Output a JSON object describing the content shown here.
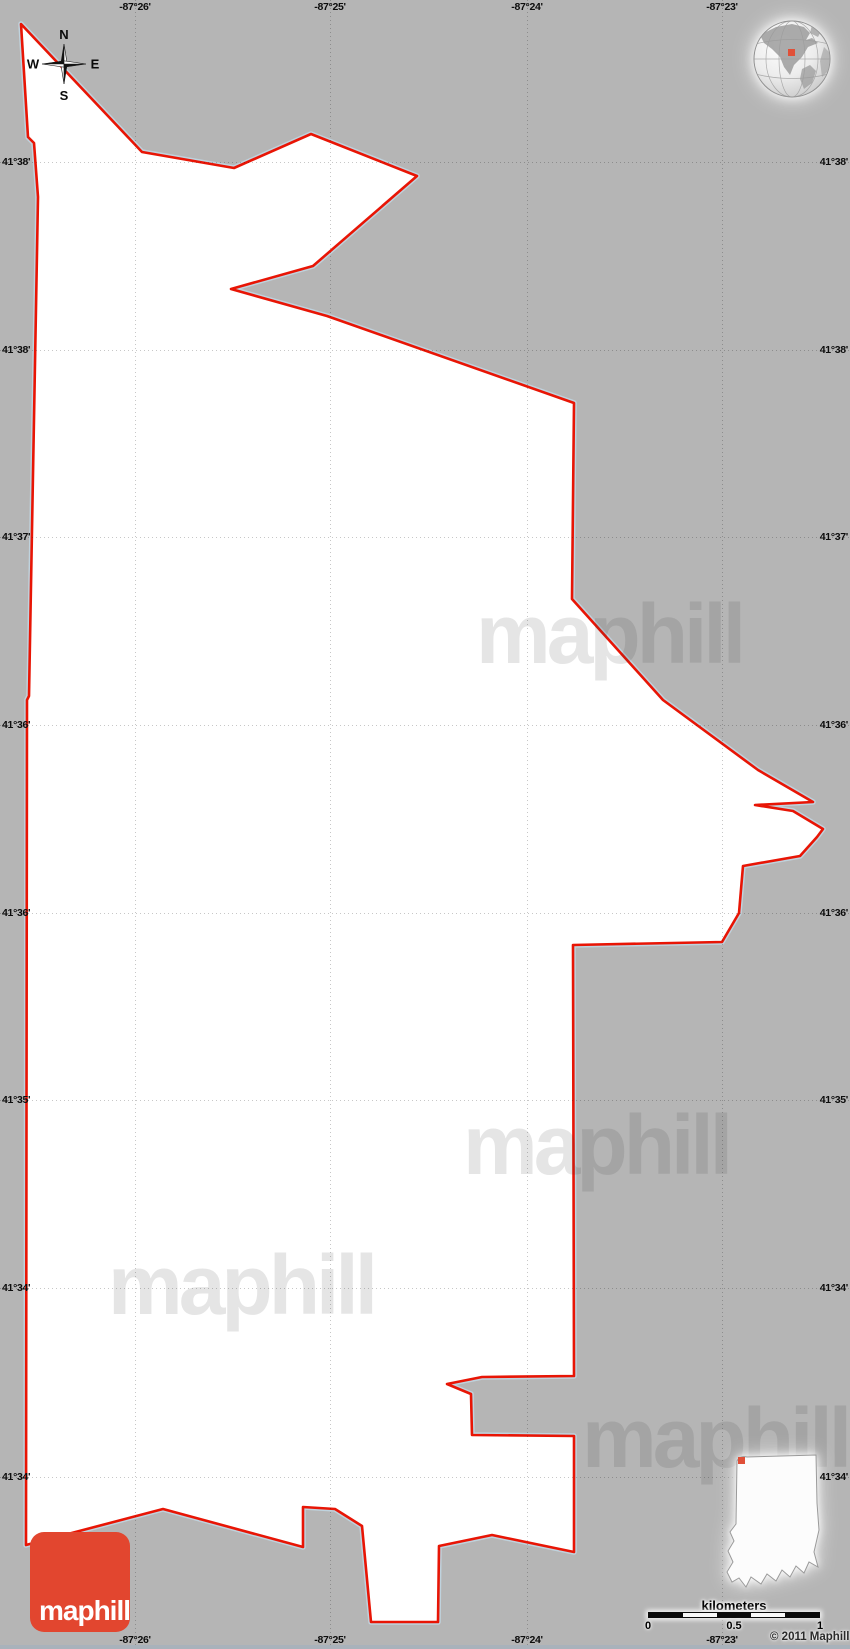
{
  "map": {
    "background_color": "#b5b5b5",
    "territory": {
      "fill": "#ffffff",
      "stroke": "#e81505",
      "casing": "#bfd3de",
      "points": [
        [
          21,
          24
        ],
        [
          142,
          152
        ],
        [
          234,
          168
        ],
        [
          311,
          134
        ],
        [
          417,
          176
        ],
        [
          313,
          266
        ],
        [
          231,
          289
        ],
        [
          327,
          316
        ],
        [
          574,
          403
        ],
        [
          572,
          599
        ],
        [
          663,
          700
        ],
        [
          758,
          770
        ],
        [
          813,
          802
        ],
        [
          755,
          805
        ],
        [
          793,
          811
        ],
        [
          823,
          829
        ],
        [
          817,
          837
        ],
        [
          800,
          856
        ],
        [
          743,
          866
        ],
        [
          739,
          913
        ],
        [
          722,
          942
        ],
        [
          573,
          945
        ],
        [
          574,
          1376
        ],
        [
          482,
          1377
        ],
        [
          447,
          1384
        ],
        [
          471,
          1394
        ],
        [
          472,
          1435
        ],
        [
          574,
          1436
        ],
        [
          574,
          1552
        ],
        [
          492,
          1535
        ],
        [
          439,
          1546
        ],
        [
          438,
          1622
        ],
        [
          371,
          1622
        ],
        [
          362,
          1526
        ],
        [
          335,
          1509
        ],
        [
          303,
          1507
        ],
        [
          303,
          1547
        ],
        [
          163,
          1509
        ],
        [
          26,
          1545
        ],
        [
          27,
          700
        ],
        [
          29,
          696
        ],
        [
          38,
          197
        ],
        [
          34,
          143
        ],
        [
          28,
          137
        ]
      ]
    },
    "bottom_strip_color": "#a9b2bb"
  },
  "grid": {
    "meridians": [
      {
        "label": "-87°26'",
        "x": 135
      },
      {
        "label": "-87°25'",
        "x": 330
      },
      {
        "label": "-87°24'",
        "x": 527
      },
      {
        "label": "-87°23'",
        "x": 722
      }
    ],
    "parallels": [
      {
        "label": "41°38'",
        "y": 162
      },
      {
        "label": "41°38'",
        "y": 350
      },
      {
        "label": "41°37'",
        "y": 537
      },
      {
        "label": "41°36'",
        "y": 725
      },
      {
        "label": "41°36'",
        "y": 913
      },
      {
        "label": "41°35'",
        "y": 1100
      },
      {
        "label": "41°34'",
        "y": 1288
      },
      {
        "label": "41°34'",
        "y": 1477
      }
    ]
  },
  "compass": {
    "north": "N",
    "south": "S",
    "east": "E",
    "west": "W"
  },
  "watermark": {
    "text": "maphill"
  },
  "scale_bar": {
    "title": "kilometers",
    "tick_labels": [
      "0",
      "0.5",
      "1"
    ],
    "segment_count": 5
  },
  "copyright": {
    "text": "© 2011 Maphill"
  },
  "logo": {
    "text": "maphill",
    "background": "#e2462f",
    "text_color": "#ffffff"
  },
  "inset": {
    "region": "indiana-locator",
    "marker_color": "#e05038"
  },
  "globe": {
    "marker_color": "#e05038"
  }
}
